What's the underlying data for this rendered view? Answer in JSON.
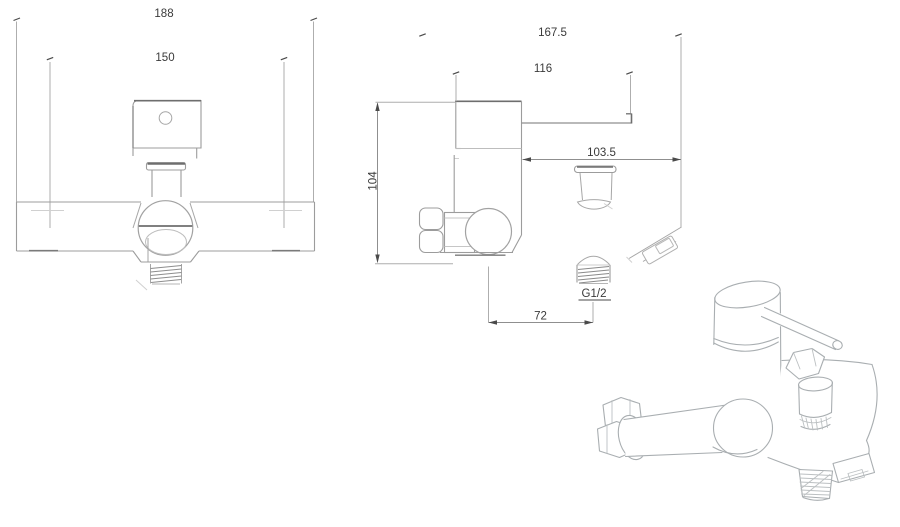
{
  "drawing": {
    "front": {
      "dims": {
        "overall_width": "188",
        "hole_spacing": "150"
      }
    },
    "side": {
      "dims": {
        "total_depth": "167.5",
        "handle_reach": "116",
        "head_offset": "103.5",
        "body_height": "104",
        "outlet_span": "72",
        "thread_size": "G1/2"
      }
    },
    "colors": {
      "line_light": "#a6a6a6",
      "line_dark": "#6e6e6e",
      "dim_text": "#3a3a3a",
      "background": "#ffffff"
    }
  }
}
